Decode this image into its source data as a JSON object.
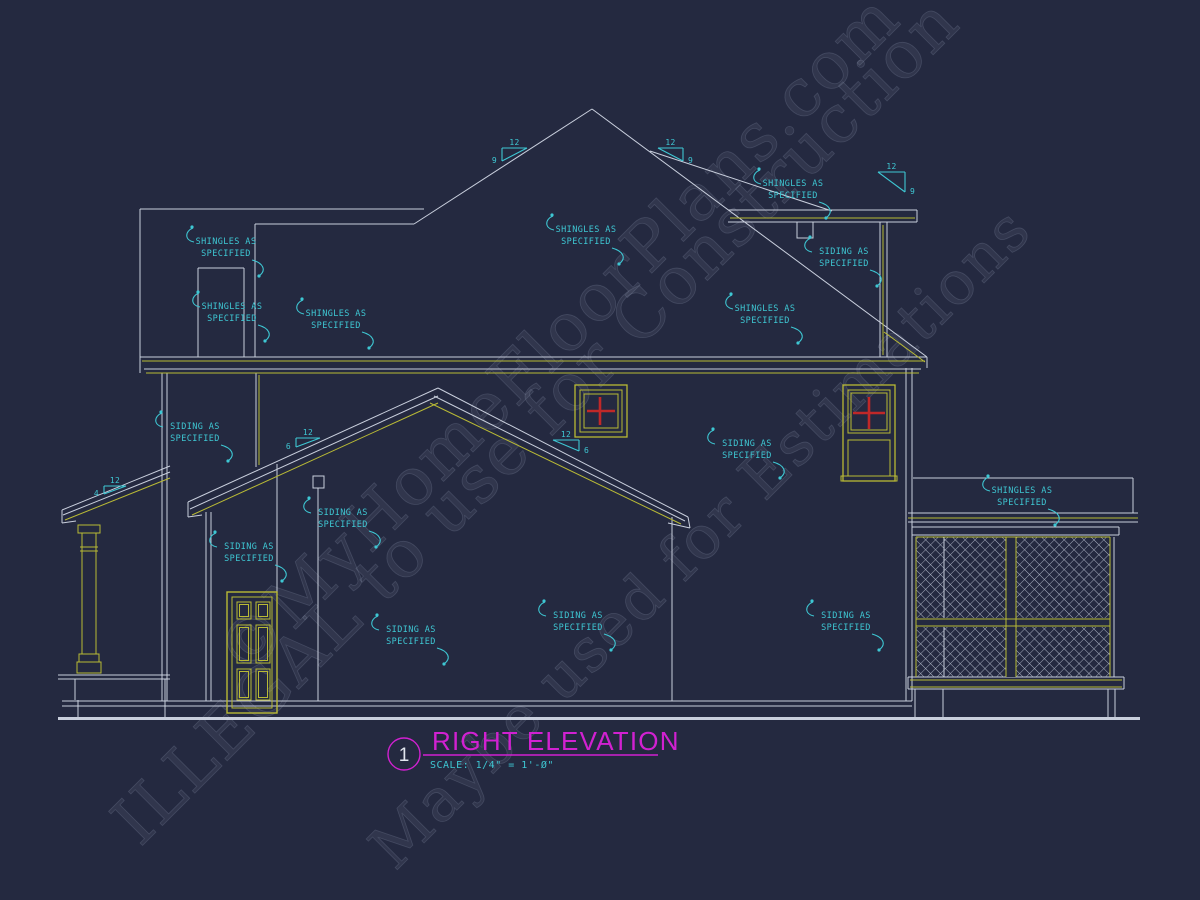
{
  "colors": {
    "background": "#242940",
    "line": "#c9cfdd",
    "trim_yellow": "#b9ba35",
    "annotation_cyan": "#3ec7d3",
    "window_red": "#c02828",
    "title_magenta": "#d121d1",
    "figure_number_white": "#e2e6ef",
    "watermark_gray": "#a6aec6"
  },
  "title_block": {
    "figure_number": "1",
    "title": "RIGHT ELEVATION",
    "scale": "SCALE: 1/4\" = 1'-Ø\""
  },
  "watermarks": [
    {
      "text": "©MyHomeFloorPlans.com",
      "x": 245,
      "y": 680,
      "size": 66
    },
    {
      "text": "ILLEGAL to use for Construction",
      "x": 140,
      "y": 848,
      "size": 66
    },
    {
      "text": "Maybe used for Estimations",
      "x": 395,
      "y": 872,
      "size": 60
    }
  ],
  "annotations": [
    {
      "id": "shingles-upper-left",
      "cx": 226,
      "y": 244,
      "lines": [
        "SHINGLES AS",
        "SPECIFIED"
      ]
    },
    {
      "id": "shingles-chimney",
      "cx": 232,
      "y": 309,
      "lines": [
        "SHINGLES AS",
        "SPECIFIED"
      ]
    },
    {
      "id": "shingles-left-wing",
      "cx": 336,
      "y": 316,
      "lines": [
        "SHINGLES AS",
        "SPECIFIED"
      ]
    },
    {
      "id": "shingles-main-roof",
      "cx": 586,
      "y": 232,
      "lines": [
        "SHINGLES AS",
        "SPECIFIED"
      ]
    },
    {
      "id": "shingles-rear-wing",
      "cx": 793,
      "y": 186,
      "lines": [
        "SHINGLES AS",
        "SPECIFIED"
      ]
    },
    {
      "id": "siding-rear-wall",
      "cx": 844,
      "y": 254,
      "lines": [
        "SIDING AS",
        "SPECIFIED"
      ]
    },
    {
      "id": "shingles-right-slope",
      "cx": 765,
      "y": 311,
      "lines": [
        "SHINGLES AS",
        "SPECIFIED"
      ]
    },
    {
      "id": "siding-left-wall",
      "cx": 195,
      "y": 429,
      "lines": [
        "SIDING AS",
        "SPECIFIED"
      ]
    },
    {
      "id": "siding-right-mid-wall",
      "cx": 747,
      "y": 446,
      "lines": [
        "SIDING AS",
        "SPECIFIED"
      ]
    },
    {
      "id": "shingles-porch-band",
      "cx": 1022,
      "y": 493,
      "lines": [
        "SHINGLES AS",
        "SPECIFIED"
      ]
    },
    {
      "id": "siding-gable-wall",
      "cx": 343,
      "y": 515,
      "lines": [
        "SIDING AS",
        "SPECIFIED"
      ]
    },
    {
      "id": "siding-door-wall",
      "cx": 249,
      "y": 549,
      "lines": [
        "SIDING AS",
        "SPECIFIED"
      ]
    },
    {
      "id": "siding-lower-left",
      "cx": 411,
      "y": 632,
      "lines": [
        "SIDING AS",
        "SPECIFIED"
      ]
    },
    {
      "id": "siding-lower-middle",
      "cx": 578,
      "y": 618,
      "lines": [
        "SIDING AS",
        "SPECIFIED"
      ]
    },
    {
      "id": "siding-lower-right",
      "cx": 846,
      "y": 618,
      "lines": [
        "SIDING AS",
        "SPECIFIED"
      ]
    }
  ],
  "pitch_markers": [
    {
      "id": "pitch-main-left",
      "x": 502,
      "y": 148,
      "w": 25,
      "h": 13,
      "dir": "left",
      "run": "12",
      "rise": "9"
    },
    {
      "id": "pitch-main-right",
      "x": 658,
      "y": 148,
      "w": 25,
      "h": 13,
      "dir": "right",
      "run": "12",
      "rise": "9"
    },
    {
      "id": "pitch-rear-wing",
      "x": 878,
      "y": 172,
      "w": 27,
      "h": 20,
      "dir": "right",
      "run": "12",
      "rise": "9"
    },
    {
      "id": "pitch-gable-right",
      "x": 553,
      "y": 440,
      "w": 26,
      "h": 11,
      "dir": "right",
      "run": "12",
      "rise": "6"
    },
    {
      "id": "pitch-gable-left",
      "x": 296,
      "y": 438,
      "w": 24,
      "h": 9,
      "dir": "left",
      "run": "12",
      "rise": "6"
    },
    {
      "id": "pitch-left-porch",
      "x": 104,
      "y": 486,
      "w": 22,
      "h": 8,
      "dir": "left",
      "run": "12",
      "rise": "4"
    }
  ]
}
